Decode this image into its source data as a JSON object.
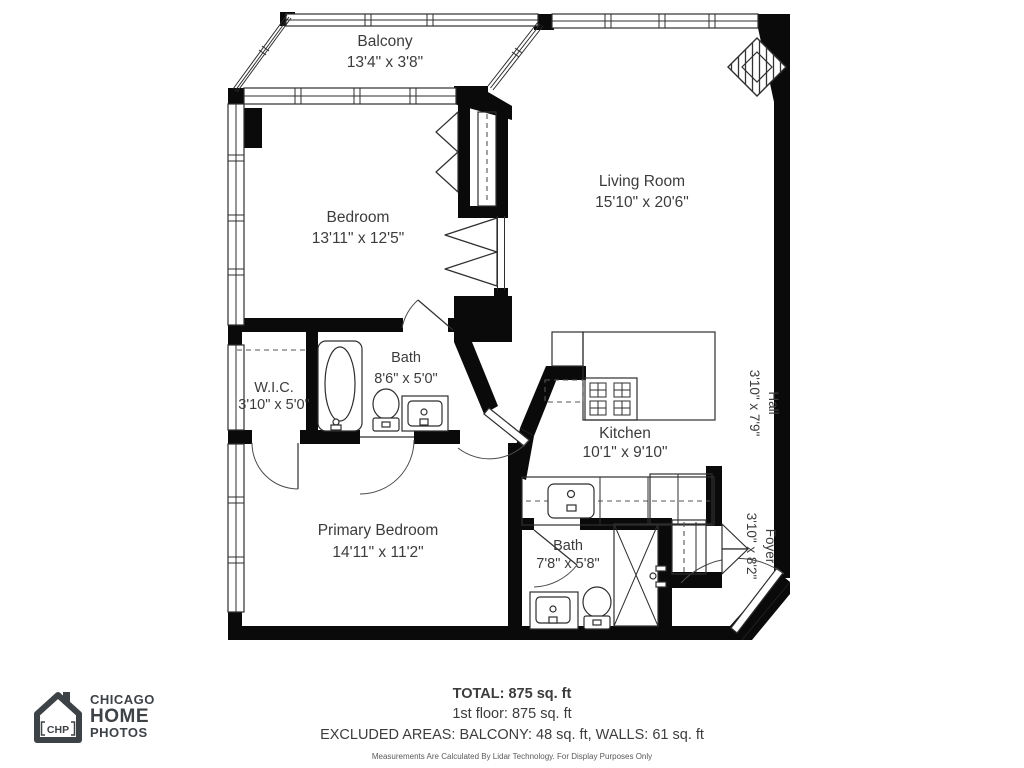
{
  "rooms": [
    {
      "name": "Balcony",
      "dims": "13'4\" x 3'8\""
    },
    {
      "name": "Bedroom",
      "dims": "13'11\" x 12'5\""
    },
    {
      "name": "Living Room",
      "dims": "15'10\" x 20'6\""
    },
    {
      "name": "Bath",
      "dims": "8'6\" x 5'0\""
    },
    {
      "name": "W.I.C.",
      "dims": "3'10\" x 5'0\""
    },
    {
      "name": "Kitchen",
      "dims": "10'1\" x 9'10\""
    },
    {
      "name": "Hall",
      "dims": "3'10\" x 7'9\""
    },
    {
      "name": "Primary Bedroom",
      "dims": "14'11\" x 11'2\""
    },
    {
      "name": "Bath",
      "dims": "7'8\" x 5'8\""
    },
    {
      "name": "Foyer",
      "dims": "3'10\" x 8'2\""
    }
  ],
  "summary": {
    "total": "TOTAL: 875 sq. ft",
    "floor": "1st floor: 875 sq. ft",
    "excluded": "EXCLUDED AREAS: BALCONY: 48 sq. ft, WALLS: 61 sq. ft",
    "disclaimer": "Measurements Are Calculated By Lidar Technology. For Display Purposes Only"
  },
  "logo": {
    "monogram": "CHP",
    "line1": "CHICAGO",
    "line2": "HOME",
    "line3": "PHOTOS"
  },
  "colors": {
    "wall": "#0a0a0a",
    "line": "#2e2e2e",
    "text": "#3c3c3c",
    "logo": "#3d4247",
    "background": "#ffffff"
  }
}
